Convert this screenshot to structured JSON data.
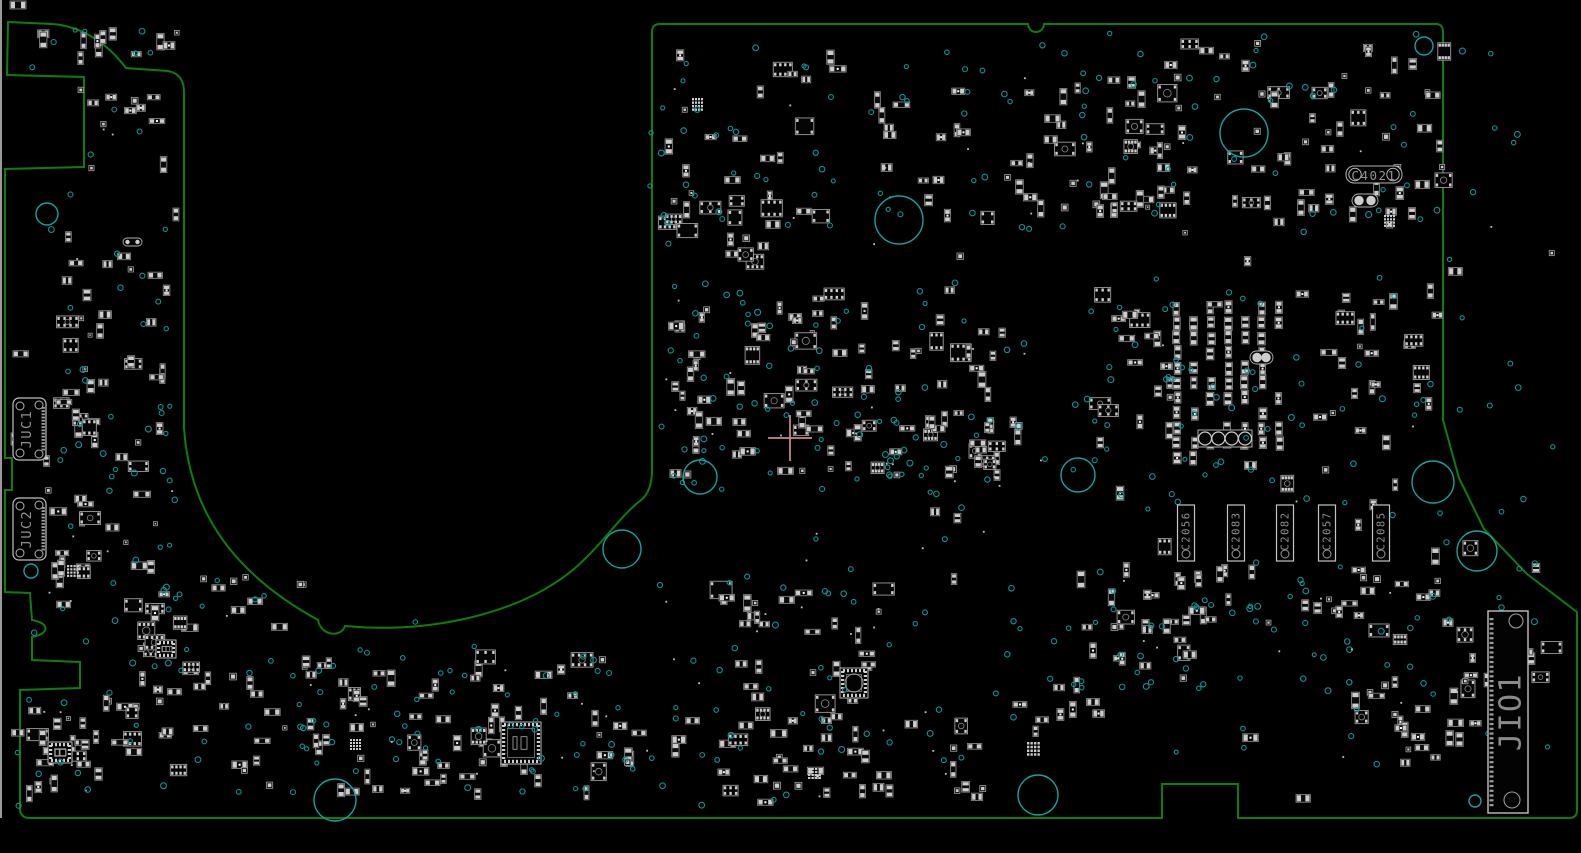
{
  "colors": {
    "background": "#000000",
    "screen_edge": "#9a9a9a",
    "board_outline": "#0e7c0e",
    "component_outline": "#8f8f8f",
    "component_pad": "#cdcdcd",
    "ic_fill": "#0b0b0b",
    "via": "#0d9494",
    "mounting_hole": "#17a1a1",
    "silkscreen_text": "#929292",
    "crosshair": "#c98f8f"
  },
  "board": {
    "outline_path": "M 8 22 L 52 24 C 82 26 108 44 126 68 L 168 71 Q 184 74 184 92 L 184 428 C 190 516 238 576 318 620 C 321 636 341 638 345 626 C 430 634 520 614 574 569 C 602 545 620 516 640 501 Q 652 492 652 470 L 652 32 Q 652 24 660 24 L 1028 24 A 8 8 0 0 0 1044 24 L 1436 24 Q 1443 24 1443 32 L 1443 420 L 1459 478 L 1484 529 L 1527 574 L 1577 612 L 1577 810 Q 1577 818 1569 818 L 1238 818 L 1238 784 L 1162 784 L 1162 818 L 30 818 Q 20 818 20 808 L 20 690 L 80 688 L 80 662 L 32 660 L 32 637 C 50 634 50 623 32 620 L 30 593 L 5 592 L 5 490 L 12 490 L 12 458 L 5 458 L 5 169 L 84 167 L 84 77 L 7 75 Z"
  },
  "reference_designators": {
    "juc1": {
      "label": "JUC1",
      "x": 13,
      "y": 398,
      "w": 33,
      "h": 62
    },
    "juc2": {
      "label": "JUC2",
      "x": 13,
      "y": 498,
      "w": 33,
      "h": 62
    },
    "jio1": {
      "label": "JIO1",
      "x": 1488,
      "y": 611,
      "w": 40,
      "h": 202
    },
    "c4021": {
      "label": "C4021",
      "x": 1346,
      "y": 166,
      "w": 56,
      "h": 17
    },
    "cap_bank": {
      "y": 505,
      "w": 17,
      "h": 56,
      "items": [
        {
          "label": "C2056",
          "cx": 1186
        },
        {
          "label": "C2083",
          "cx": 1236
        },
        {
          "label": "C2082",
          "cx": 1285
        },
        {
          "label": "C2057",
          "cx": 1327
        },
        {
          "label": "C2085",
          "cx": 1381
        }
      ]
    }
  },
  "mounting_holes": [
    [
      47,
      214,
      11
    ],
    [
      31,
      571,
      7
    ],
    [
      622,
      549,
      19
    ],
    [
      700,
      477,
      17
    ],
    [
      1078,
      475,
      17
    ],
    [
      899,
      220,
      24
    ],
    [
      1244,
      133,
      24
    ],
    [
      1424,
      46,
      9
    ],
    [
      1433,
      482,
      21
    ],
    [
      1477,
      551,
      20
    ],
    [
      335,
      800,
      21
    ],
    [
      1038,
      795,
      20
    ],
    [
      1507,
      797,
      8
    ],
    [
      1475,
      801,
      6
    ]
  ],
  "crosshair": {
    "x": 790,
    "y": 438,
    "arm_h": 22,
    "arm_v": 23
  },
  "generator": {
    "seed": 20240610,
    "component_clusters": [
      [
        30,
        22,
        150,
        45,
        12,
        0
      ],
      [
        90,
        95,
        75,
        40,
        8,
        0
      ],
      [
        60,
        235,
        110,
        105,
        14,
        0
      ],
      [
        55,
        355,
        115,
        125,
        20,
        0
      ],
      [
        48,
        480,
        120,
        145,
        20,
        0
      ],
      [
        140,
        575,
        165,
        115,
        26,
        0
      ],
      [
        25,
        690,
        115,
        115,
        24,
        0
      ],
      [
        155,
        685,
        150,
        105,
        16,
        0
      ],
      [
        305,
        655,
        300,
        140,
        65,
        0
      ],
      [
        660,
        55,
        420,
        170,
        50,
        0
      ],
      [
        1085,
        40,
        330,
        185,
        48,
        0
      ],
      [
        672,
        215,
        110,
        120,
        12,
        0
      ],
      [
        672,
        290,
        330,
        185,
        85,
        0
      ],
      [
        890,
        420,
        130,
        60,
        12,
        0
      ],
      [
        1090,
        85,
        110,
        130,
        14,
        0
      ],
      [
        1098,
        275,
        85,
        170,
        16,
        0
      ],
      [
        1168,
        300,
        135,
        195,
        55,
        1
      ],
      [
        1305,
        285,
        135,
        135,
        22,
        0
      ],
      [
        1295,
        90,
        150,
        125,
        18,
        0
      ],
      [
        1080,
        555,
        110,
        135,
        20,
        0
      ],
      [
        1170,
        570,
        270,
        55,
        24,
        0
      ],
      [
        1350,
        630,
        95,
        145,
        18,
        0
      ],
      [
        700,
        585,
        185,
        150,
        26,
        0
      ],
      [
        718,
        715,
        265,
        85,
        32,
        0
      ],
      [
        1440,
        600,
        115,
        215,
        14,
        0
      ],
      [
        660,
        35,
        900,
        770,
        70,
        0
      ],
      [
        15,
        80,
        165,
        720,
        20,
        0
      ],
      [
        605,
        690,
        90,
        80,
        8,
        0
      ],
      [
        1000,
        620,
        100,
        100,
        8,
        0
      ]
    ],
    "via_clusters": [
      [
        650,
        200,
        450,
        300,
        40
      ],
      [
        300,
        620,
        420,
        180,
        35
      ],
      [
        1050,
        450,
        400,
        250,
        40
      ],
      [
        700,
        450,
        350,
        200,
        25
      ],
      [
        60,
        350,
        130,
        300,
        15
      ],
      [
        640,
        60,
        420,
        160,
        25
      ],
      [
        1440,
        40,
        130,
        560,
        18
      ]
    ],
    "specials": {
      "qfn": [
        [
          501,
          722,
          40,
          42,
          0
        ],
        [
          840,
          668,
          28,
          30,
          9
        ],
        [
          48,
          742,
          24,
          21,
          0
        ],
        [
          156,
          640,
          20,
          18,
          0
        ]
      ],
      "dot_grids": [
        [
          1384,
          215,
          12,
          13
        ],
        [
          1027,
          742,
          14,
          15
        ],
        [
          67,
          565,
          13,
          13
        ],
        [
          350,
          739,
          12,
          12
        ],
        [
          692,
          98,
          12,
          14
        ],
        [
          808,
          768,
          14,
          12
        ]
      ],
      "dual_round": [
        [
          1250,
          351,
          23,
          13
        ],
        [
          1352,
          194,
          26,
          13
        ],
        [
          123,
          238,
          19,
          8
        ]
      ],
      "quad_round": [
        [
          1198,
          430,
          54,
          17
        ]
      ],
      "small_parts": [
        [
          10,
          1,
          16,
          8
        ]
      ]
    }
  }
}
